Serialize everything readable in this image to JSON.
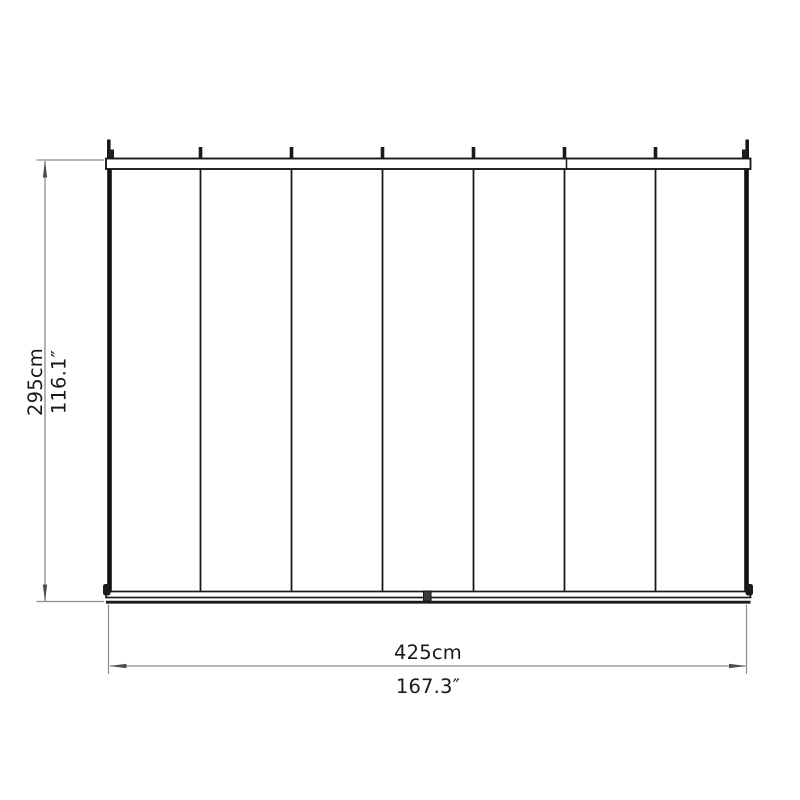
{
  "diagram": {
    "type": "technical-dimension-drawing",
    "subject": "panel structure top view with 7 panels",
    "panel_count": 7,
    "dimensions": {
      "height_metric": "295cm",
      "height_imperial": "116.1″",
      "width_metric": "425cm",
      "width_imperial": "167.3″"
    },
    "colors": {
      "structure_line": "#1a1a1a",
      "dimension_line": "#8c8c8c",
      "arrow": "#4d4d4d",
      "text": "#1a1a1a",
      "background": "#ffffff"
    }
  }
}
